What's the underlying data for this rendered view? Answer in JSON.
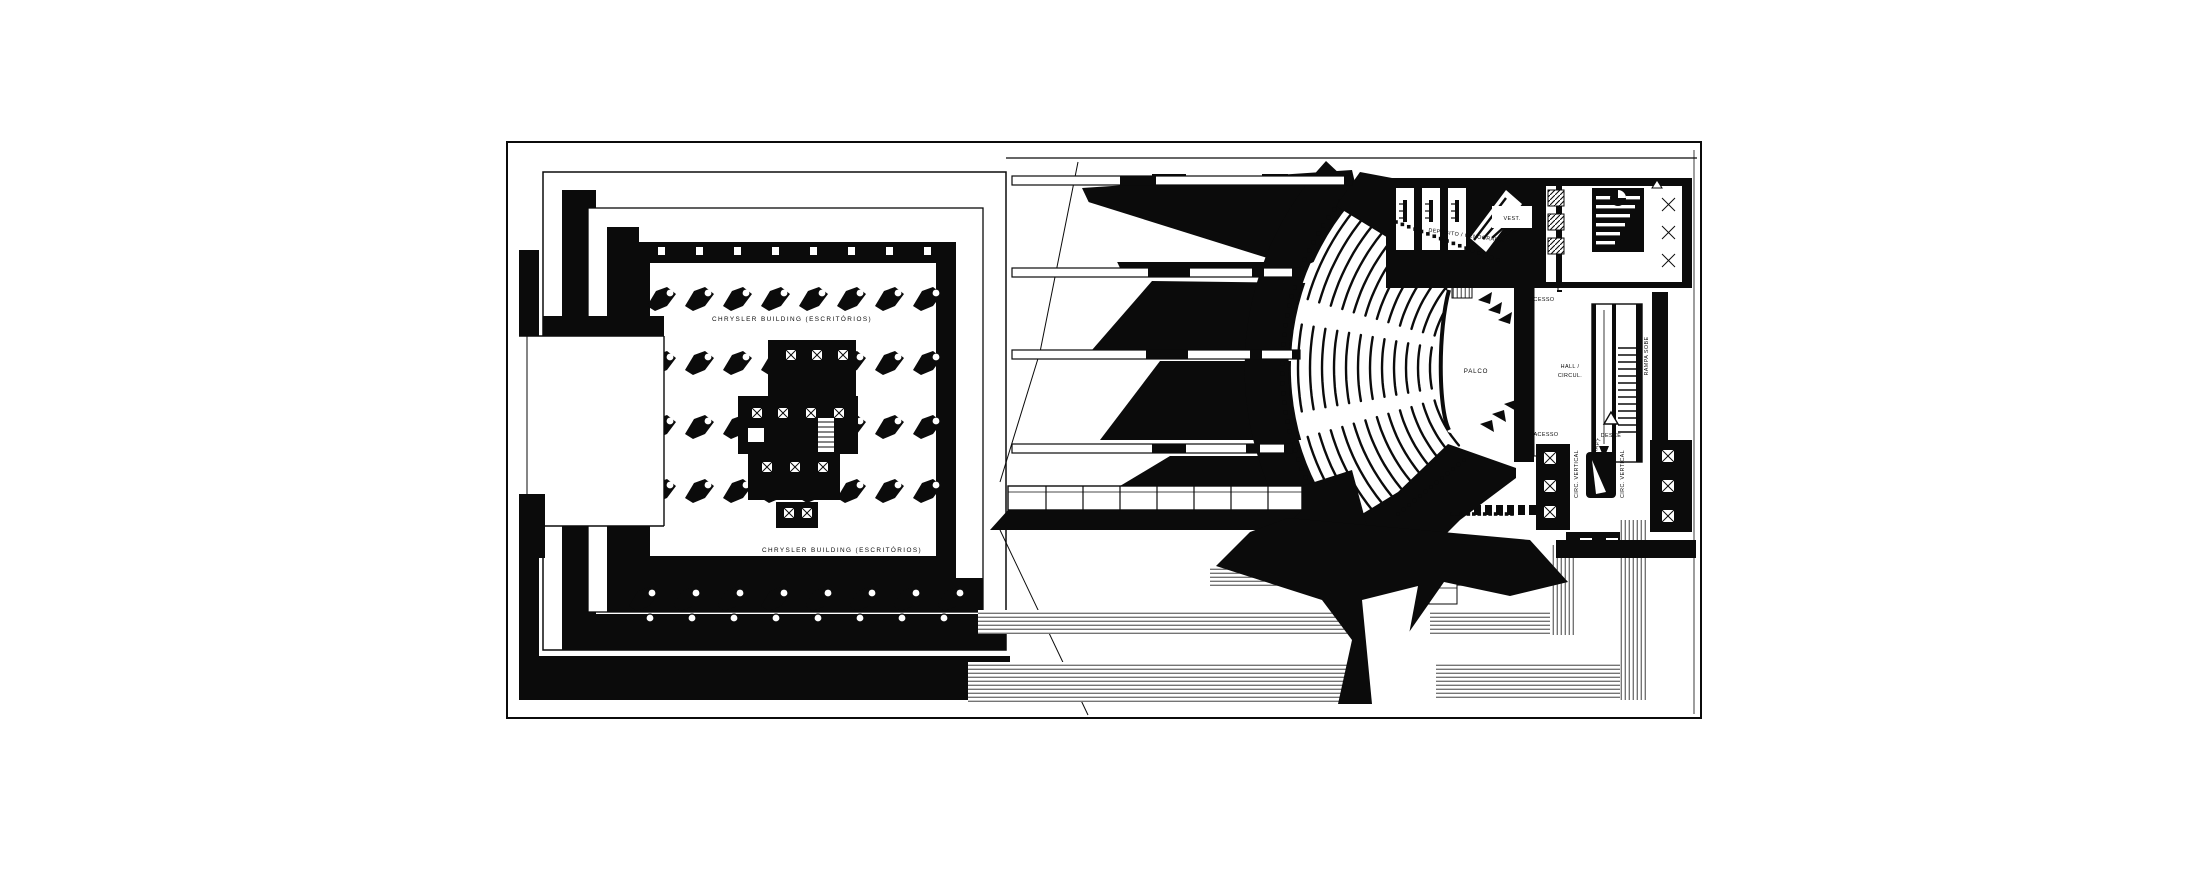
{
  "document": {
    "type": "architectural floor plan drawing",
    "left_block": "office tower plan",
    "right_block": "theater auditorium plan"
  },
  "labels": {
    "chrysler_top": "CHRYSLER BUILDING (ESCRITÓRIOS)",
    "chrysler_bottom": "CHRYSLER BUILDING (ESCRITÓRIOS)",
    "deposito": "DEPÓSITO / CENOGRAFIA",
    "vest": "VEST.",
    "acesso_top": "ACESSO",
    "palco": "PALCO",
    "hall_line1": "HALL /",
    "hall_line2": "CIRCUL.",
    "rampa": "RAMPA SOBE",
    "desce": "DESCE",
    "acesso_bottom": "ACESSO",
    "circ_vertical_left": "CIRC. VERTICAL",
    "shaft": "SHAFT",
    "circ_vertical_right": "CIRC. VERTICAL"
  },
  "colors": {
    "ink": "#0b0b0b",
    "paper": "#ffffff"
  }
}
